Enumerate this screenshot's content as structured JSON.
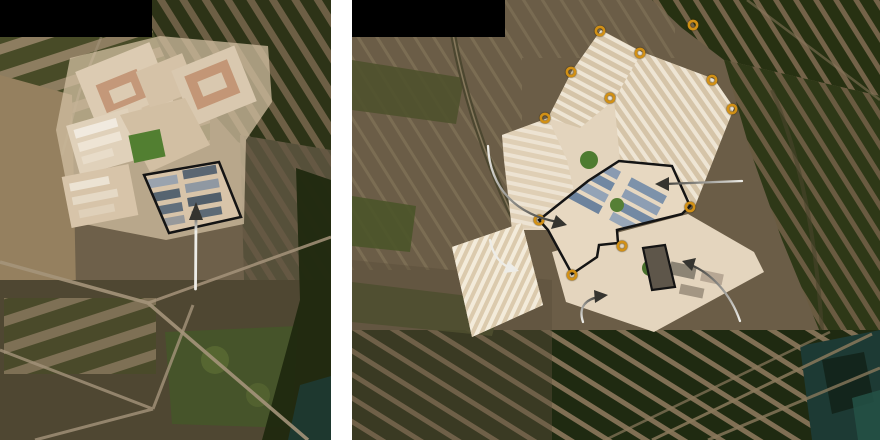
{
  "palette": {
    "page_background": "#ffffff",
    "redaction": "#000000",
    "tower_ring": "#d19016",
    "footprint_outline": "#141414",
    "arrow_light": "#edece7",
    "arrow_dark": "#35342f"
  },
  "panels": {
    "left": {
      "role": "satellite-view-earlier",
      "redaction_box": {
        "x": 0,
        "y": 0,
        "width": 152,
        "height": 37
      },
      "compound_outline": {
        "points": "144,175 219,162 241,217 169,233"
      },
      "pointer": {
        "shaft": "M195.5,289 L196,219",
        "head": "M196,202 L203,220 L189,220 Z"
      }
    },
    "right": {
      "role": "satellite-view-later",
      "redaction_box": {
        "x": 0,
        "y": 0,
        "width": 153,
        "height": 37
      },
      "towers": [
        {
          "cx": 248,
          "cy": 31
        },
        {
          "cx": 341,
          "cy": 25
        },
        {
          "cx": 288,
          "cy": 53
        },
        {
          "cx": 219,
          "cy": 72
        },
        {
          "cx": 360,
          "cy": 80
        },
        {
          "cx": 258,
          "cy": 98
        },
        {
          "cx": 380,
          "cy": 109
        },
        {
          "cx": 193,
          "cy": 118
        },
        {
          "cx": 338,
          "cy": 207
        },
        {
          "cx": 187,
          "cy": 220
        },
        {
          "cx": 270,
          "cy": 246
        },
        {
          "cx": 220,
          "cy": 275
        }
      ],
      "footprint_outline": {
        "points": "187,220 236,181 267,161 320,166 338,206 330,214 265,230 266,243 247,245 245,257 220,274 196,230"
      },
      "building_outline": {
        "points": "291,248 313,245 323,287 300,290"
      },
      "arrows": [
        {
          "name": "arc-into-central-compound",
          "shaft": "M136,146 C138,190 166,215 206,222",
          "head": "M215,225 L199,229 L204,215 Z"
        },
        {
          "name": "straight-to-blue-roof-block",
          "shaft": "M390,181 L312,184",
          "head": "M303,184 L317,177 L317,191 Z"
        },
        {
          "name": "arc-to-new-warehouse",
          "shaft": "M138,240 C141,256 149,264 158,268",
          "head": "M167,271 L152,273 L156,261 Z"
        },
        {
          "name": "arc-up-to-south-yard",
          "shaft": "M231,322 C226,307 234,299 247,297",
          "head": "M256,295 L243,303 L242,290 Z"
        },
        {
          "name": "arc-to-outlined-building",
          "shaft": "M388,321 C378,292 358,273 339,265",
          "head": "M330,261 L344,258 L340,271 Z"
        }
      ]
    }
  }
}
